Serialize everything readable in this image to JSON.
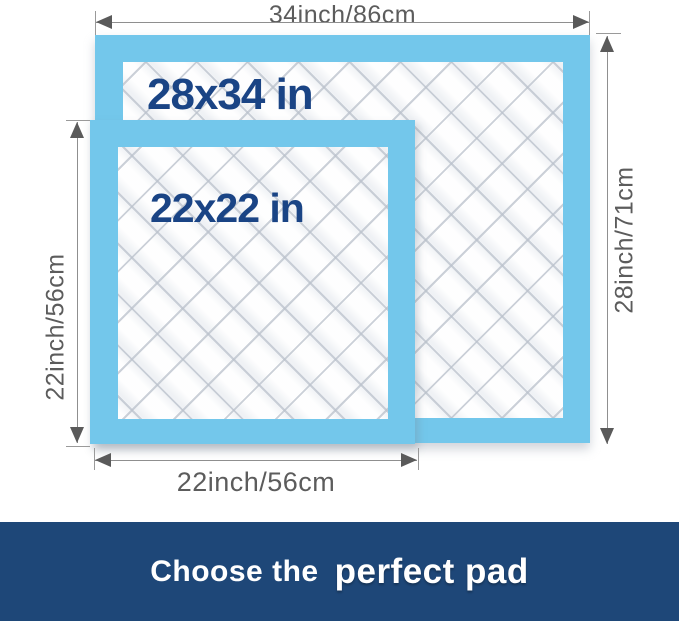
{
  "title": "Pad size comparison diagram",
  "diagram": {
    "pad_large": {
      "size_label": "28x34 in"
    },
    "pad_small": {
      "size_label": "22x22 in"
    },
    "dimension_top": {
      "label": "34inch/86cm"
    },
    "dimension_right": {
      "label": "28inch/71cm"
    },
    "dimension_left": {
      "label": "22inch/56cm"
    },
    "dimension_bottom": {
      "label": "22inch/56cm"
    },
    "colors": {
      "pad_border_blue": "#73C7EB",
      "pad_quilt_white": "#F8F9FB",
      "size_text_navy": "#1A4485",
      "dimension_gray": "#5C5C5C",
      "banner_navy": "#1E4778",
      "banner_text_white": "#FFFFFF"
    }
  },
  "banner": {
    "text_regular": "Choose the",
    "text_bold": "perfect pad"
  }
}
